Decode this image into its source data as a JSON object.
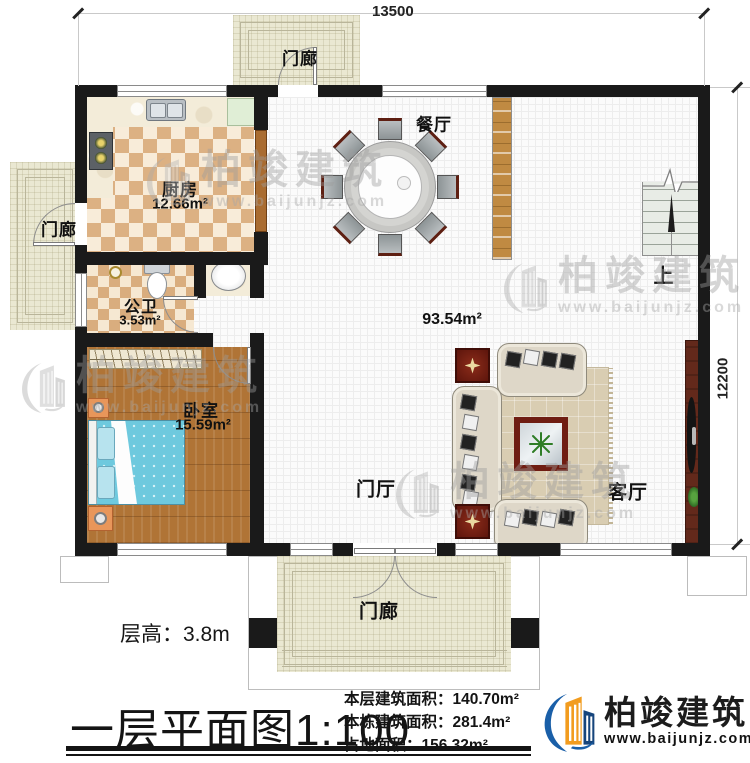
{
  "dimensions": {
    "top": "13500",
    "right": "12200"
  },
  "rooms": {
    "porch_top": "门廊",
    "porch_left": "门廊",
    "porch_bottom": "门廊",
    "kitchen": {
      "name": "厨房",
      "area": "12.66m²"
    },
    "bathroom": {
      "name": "公卫",
      "area": "3.53m²"
    },
    "bedroom": {
      "name": "卧室",
      "area": "15.59m²"
    },
    "dining": "餐厅",
    "foyer": "门厅",
    "living": "客厅",
    "main_area": "93.54m²",
    "stairs_up": "上"
  },
  "footer": {
    "floor_height": "层高：3.8m",
    "title": "一层平面图",
    "scale": "1:100",
    "stats": [
      {
        "label": "本层建筑面积：",
        "value": "140.70m²"
      },
      {
        "label": "本栋建筑面积：",
        "value": "281.4m²"
      },
      {
        "label": "占地面积：",
        "value": "156.32m²"
      }
    ],
    "brand": {
      "name": "柏竣建筑",
      "url": "www.baijunjz.com"
    }
  },
  "watermark": {
    "name": "柏竣建筑",
    "url": "www.baijunjz.com"
  },
  "colors": {
    "wall": "#1a1a1a",
    "wood_floor": "#b07436",
    "bed_blue": "#6ec9de",
    "brand_blue": "#1a5fa8",
    "brand_orange": "#f29c1f"
  }
}
